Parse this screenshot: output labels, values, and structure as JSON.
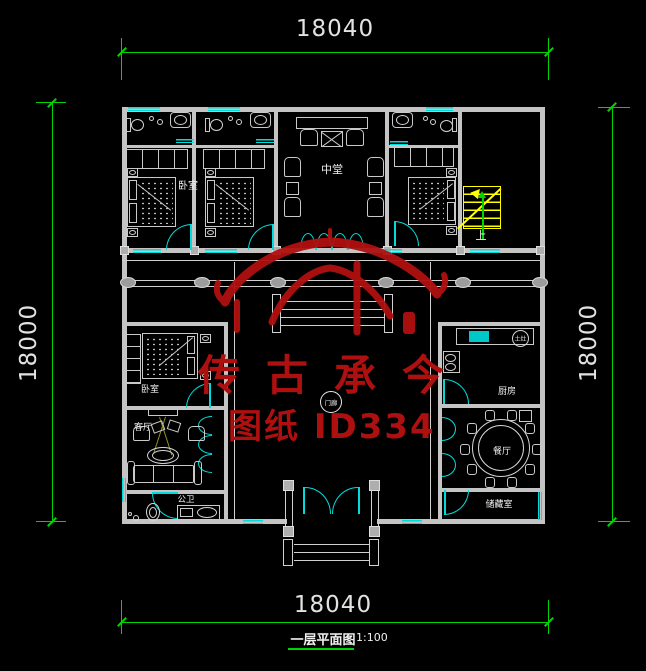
{
  "drawing": {
    "background": "#000000",
    "dim_color": "#00d400",
    "wall_color": "#c4c4c4",
    "window_color": "#00dcdc",
    "stair_color": "#ffff00",
    "dimensions": {
      "top": "18040",
      "bottom": "18040",
      "left": "18000",
      "right": "18000"
    },
    "title": {
      "name": "一层平面图",
      "scale": "1:100"
    },
    "rooms": {
      "bedroom_top": "卧室",
      "hall": "中堂",
      "bedroom_left": "卧室",
      "living": "客厅",
      "bath": "公卫",
      "kitchen": "厨房",
      "dining": "餐厅",
      "storage": "储藏室",
      "porch": "门廊",
      "stairs_up": "上",
      "stove": "土灶"
    },
    "watermark": {
      "line1": "传古承今",
      "line2": "图纸 ID334",
      "color": "#ae0f0f"
    }
  }
}
